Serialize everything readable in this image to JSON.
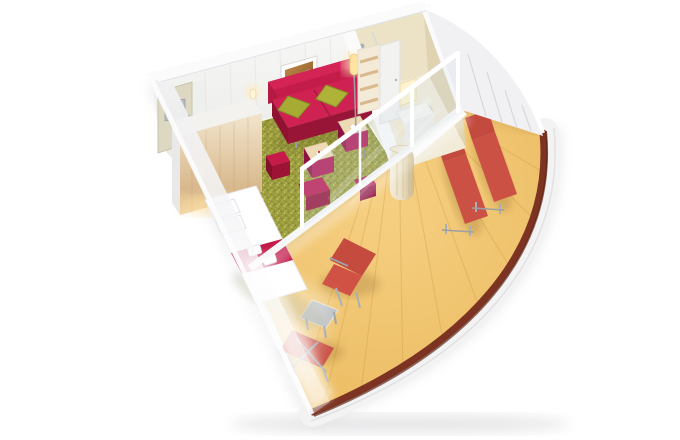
{
  "scene": {
    "kind": "isometric-3d-cutaway-floorplan",
    "subject": "cruise-ship-balcony-cabin",
    "rooms": [
      {
        "name": "entrance-hall",
        "objects": [
          "cabin-door",
          "wardrobe"
        ]
      },
      {
        "name": "bathroom",
        "objects": [
          "shower",
          "toilet",
          "sink",
          "vanity-mirror"
        ]
      },
      {
        "name": "sleeping-area",
        "objects": [
          "double-bed",
          "bed-runner",
          "pillows",
          "towels",
          "bed-bench"
        ]
      },
      {
        "name": "living-area",
        "objects": [
          "red-sofa",
          "green-cushions",
          "wall-art",
          "floor-lamp",
          "wall-sconce",
          "ottoman-tray-table",
          "ottoman-tray-table",
          "red-cube-stool",
          "magenta-cube-stool",
          "shelving-unit",
          "vanity-desk",
          "curtain"
        ]
      },
      {
        "name": "balcony",
        "objects": [
          "sun-lounger",
          "sun-lounger",
          "deck-chair",
          "side-table",
          "folding-lounger",
          "railing",
          "sliding-glass-door"
        ]
      }
    ]
  },
  "colors": {
    "background": "#ffffff",
    "wall_top": "#fbfbfc",
    "wall_face_light": "#f8f8f6",
    "wall_face_dark": "#eaeae8",
    "wall_shade": "#e7e7ea",
    "hull_white": "#f3f3f4",
    "panel_line": "#d7d7db",
    "carpet_base": "#9b9c3e",
    "carpet_dot_dark": "#7f8230",
    "carpet_dot_light": "#c2c25e",
    "deck_center": "#f6d083",
    "deck_edge": "#eaba5e",
    "deck_seam": "#c9973f",
    "rail_brown": "#7d3322",
    "rail_shadow": "#5f2415",
    "sofa_red": "#c41c4a",
    "sofa_red_dark": "#981537",
    "sofa_red_light": "#d42355",
    "pillow_green": "#a6ab33",
    "pillow_green_dark": "#878c24",
    "ottoman_magenta": "#b01a55",
    "ottoman_dark": "#8c1242",
    "tray_wood": "#eedbb6",
    "stool_red": "#c61b49",
    "runner_red": "#c21747",
    "bed_white": "#ffffff",
    "bed_shadow": "#e7eaee",
    "wood_light": "#f3e7d0",
    "wood_dark": "#d8b88c",
    "door_beige": "#dcd8c2",
    "door_panel": "#b9bdc0",
    "bath_tile": "#ece2c6",
    "bath_tile_dark": "#e0d3b2",
    "bath_floor": "#f1ebd8",
    "glass_tint": "#cfe0e8",
    "curtain_beige": "#eadfc4",
    "lounger_red": "#cc5145",
    "lounger_red_dark": "#c24a3e",
    "frame_grey": "#a9b0b5",
    "table_grey": "#b9bec2",
    "glow_warm": "#ffe3a1",
    "art_amber": "#c08a4a",
    "art_amber_dark": "#8a5a28",
    "shadow_grey": "#c7c7ca"
  }
}
